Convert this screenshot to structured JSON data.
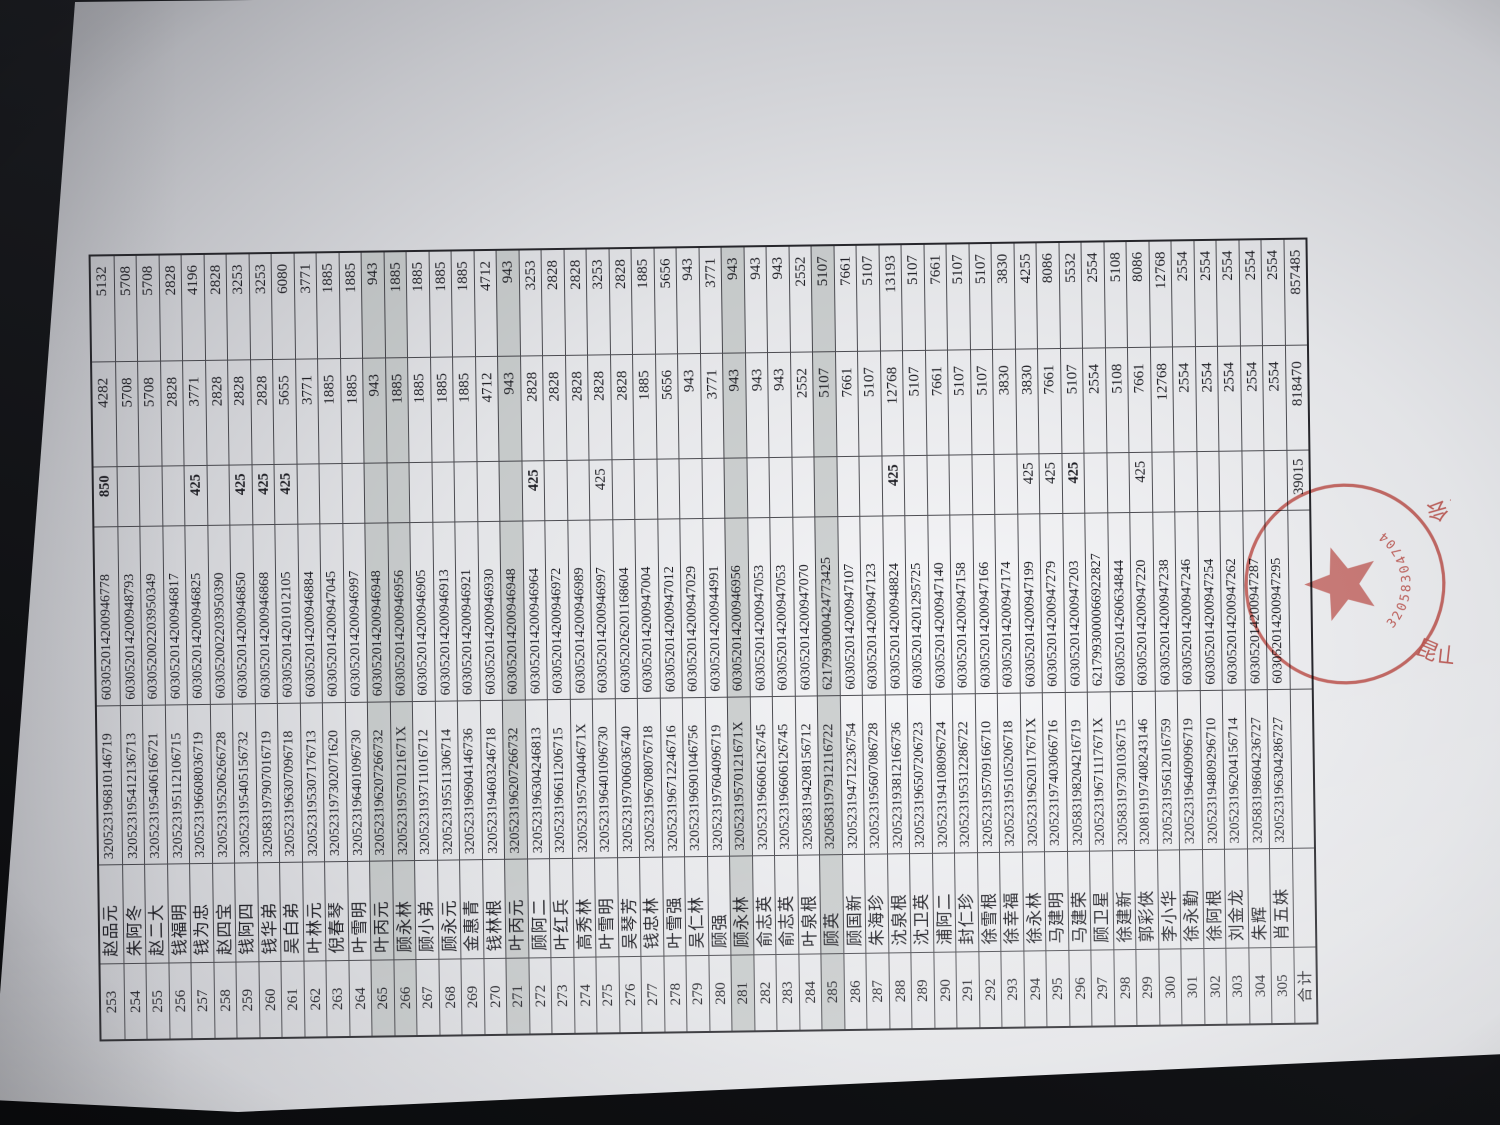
{
  "table": {
    "rows": [
      {
        "no": "253",
        "name": "赵品元",
        "id": "320523196810146719",
        "account": "603052014200946778",
        "adj": "850",
        "base": "4282",
        "total": "5132",
        "bold_adj": true
      },
      {
        "no": "254",
        "name": "朱阿冬",
        "id": "320523195412136713",
        "account": "603052014200948793",
        "adj": "",
        "base": "5708",
        "total": "5708"
      },
      {
        "no": "255",
        "name": "赵二大",
        "id": "320523195406166721",
        "account": "603052002203950349",
        "adj": "",
        "base": "5708",
        "total": "5708"
      },
      {
        "no": "256",
        "name": "钱福明",
        "id": "320523195112106715",
        "account": "603052014200946817",
        "adj": "",
        "base": "2828",
        "total": "2828"
      },
      {
        "no": "257",
        "name": "钱为忠",
        "id": "320523196608036719",
        "account": "603052014200946825",
        "adj": "425",
        "base": "3771",
        "total": "4196",
        "bold_adj": true
      },
      {
        "no": "258",
        "name": "赵四宝",
        "id": "320523195206266728",
        "account": "603052002203950390",
        "adj": "",
        "base": "2828",
        "total": "2828"
      },
      {
        "no": "259",
        "name": "钱阿四",
        "id": "320523195405156732",
        "account": "603052014200946850",
        "adj": "425",
        "base": "2828",
        "total": "3253",
        "bold_adj": true
      },
      {
        "no": "260",
        "name": "钱华弟",
        "id": "320583197907016719",
        "account": "603052014200946868",
        "adj": "425",
        "base": "2828",
        "total": "3253",
        "bold_adj": true
      },
      {
        "no": "261",
        "name": "吴白弟",
        "id": "320523196307096718",
        "account": "603052014201012105",
        "adj": "425",
        "base": "5655",
        "total": "6080",
        "bold_adj": true
      },
      {
        "no": "262",
        "name": "叶林元",
        "id": "320523195307176713",
        "account": "603052014200946884",
        "adj": "",
        "base": "3771",
        "total": "3771"
      },
      {
        "no": "263",
        "name": "倪春琴",
        "id": "320523197302071620",
        "account": "603052014200947045",
        "adj": "",
        "base": "1885",
        "total": "1885"
      },
      {
        "no": "264",
        "name": "叶雪明",
        "id": "320523196401096730",
        "account": "603052014200946997",
        "adj": "",
        "base": "1885",
        "total": "1885"
      },
      {
        "no": "265",
        "name": "叶丙元",
        "id": "320523196207266732",
        "account": "603052014200946948",
        "adj": "",
        "base": "943",
        "total": "943",
        "shaded": true
      },
      {
        "no": "266",
        "name": "顾永林",
        "id": "32052319570121671X",
        "account": "603052014200946956",
        "adj": "",
        "base": "1885",
        "total": "1885",
        "shaded": true
      },
      {
        "no": "267",
        "name": "顾小弟",
        "id": "320523193711016712",
        "account": "603052014200946905",
        "adj": "",
        "base": "1885",
        "total": "1885"
      },
      {
        "no": "268",
        "name": "顾永元",
        "id": "320523195511306714",
        "account": "603052014200946913",
        "adj": "",
        "base": "1885",
        "total": "1885"
      },
      {
        "no": "269",
        "name": "金惠青",
        "id": "320523196904146736",
        "account": "603052014200946921",
        "adj": "",
        "base": "1885",
        "total": "1885"
      },
      {
        "no": "270",
        "name": "钱林根",
        "id": "320523194603246718",
        "account": "603052014200946930",
        "adj": "",
        "base": "4712",
        "total": "4712"
      },
      {
        "no": "271",
        "name": "叶丙元",
        "id": "320523196207266732",
        "account": "603052014200946948",
        "adj": "",
        "base": "943",
        "total": "943",
        "shaded": true
      },
      {
        "no": "272",
        "name": "顾阿二",
        "id": "320523196304246813",
        "account": "603052014200946964",
        "adj": "425",
        "base": "2828",
        "total": "3253",
        "bold_adj": true
      },
      {
        "no": "273",
        "name": "叶红兵",
        "id": "320523196611206715",
        "account": "603052014200946972",
        "adj": "",
        "base": "2828",
        "total": "2828"
      },
      {
        "no": "274",
        "name": "高秀林",
        "id": "32052319570404671X",
        "account": "603052014200946989",
        "adj": "",
        "base": "2828",
        "total": "2828"
      },
      {
        "no": "275",
        "name": "叶雪明",
        "id": "320523196401096730",
        "account": "603052014200946997",
        "adj": "425",
        "base": "2828",
        "total": "3253"
      },
      {
        "no": "276",
        "name": "吴琴芳",
        "id": "320523197006036740",
        "account": "603052026201168604",
        "adj": "",
        "base": "2828",
        "total": "2828"
      },
      {
        "no": "277",
        "name": "钱忠林",
        "id": "320523196708076718",
        "account": "603052014200947004",
        "adj": "",
        "base": "1885",
        "total": "1885"
      },
      {
        "no": "278",
        "name": "叶雪强",
        "id": "320523196712246716",
        "account": "603052014200947012",
        "adj": "",
        "base": "5656",
        "total": "5656"
      },
      {
        "no": "279",
        "name": "吴仁林",
        "id": "320523196901046756",
        "account": "603052014200947029",
        "adj": "",
        "base": "943",
        "total": "943"
      },
      {
        "no": "280",
        "name": "顾强",
        "id": "320523197604096719",
        "account": "603052014200944991",
        "adj": "",
        "base": "3771",
        "total": "3771"
      },
      {
        "no": "281",
        "name": "顾永林",
        "id": "32052319570121671X",
        "account": "603052014200946956",
        "adj": "",
        "base": "943",
        "total": "943",
        "shaded": true
      },
      {
        "no": "282",
        "name": "俞志英",
        "id": "320523196606126745",
        "account": "603052014200947053",
        "adj": "",
        "base": "943",
        "total": "943"
      },
      {
        "no": "283",
        "name": "俞志英",
        "id": "320523196606126745",
        "account": "603052014200947053",
        "adj": "",
        "base": "943",
        "total": "943"
      },
      {
        "no": "284",
        "name": "叶泉根",
        "id": "320583194208156712",
        "account": "603052014200947070",
        "adj": "",
        "base": "2552",
        "total": "2552"
      },
      {
        "no": "285",
        "name": "顾英",
        "id": "320583197912116722",
        "account": "6217993000424773425",
        "adj": "",
        "base": "5107",
        "total": "5107",
        "shaded": true
      },
      {
        "no": "286",
        "name": "顾国新",
        "id": "320523194712236754",
        "account": "603052014200947107",
        "adj": "",
        "base": "7661",
        "total": "7661"
      },
      {
        "no": "287",
        "name": "朱海珍",
        "id": "320523195607086728",
        "account": "603052014200947123",
        "adj": "",
        "base": "5107",
        "total": "5107"
      },
      {
        "no": "288",
        "name": "沈泉根",
        "id": "320523193812166736",
        "account": "603052014200948824",
        "adj": "425",
        "base": "12768",
        "total": "13193",
        "bold_adj": true
      },
      {
        "no": "289",
        "name": "沈卫英",
        "id": "320523196507206723",
        "account": "603052014201295725",
        "adj": "",
        "base": "5107",
        "total": "5107"
      },
      {
        "no": "290",
        "name": "浦阿二",
        "id": "320523194108096724",
        "account": "603052014200947140",
        "adj": "",
        "base": "7661",
        "total": "7661"
      },
      {
        "no": "291",
        "name": "封仁珍",
        "id": "320523195312286722",
        "account": "603052014200947158",
        "adj": "",
        "base": "5107",
        "total": "5107"
      },
      {
        "no": "292",
        "name": "徐雪根",
        "id": "320523195709166710",
        "account": "603052014200947166",
        "adj": "",
        "base": "5107",
        "total": "5107"
      },
      {
        "no": "293",
        "name": "徐幸福",
        "id": "320523195105206718",
        "account": "603052014200947174",
        "adj": "",
        "base": "3830",
        "total": "3830"
      },
      {
        "no": "294",
        "name": "徐永林",
        "id": "32052319620117671X",
        "account": "603052014200947199",
        "adj": "425",
        "base": "3830",
        "total": "4255"
      },
      {
        "no": "295",
        "name": "马建明",
        "id": "320523197403066716",
        "account": "603052014200947279",
        "adj": "425",
        "base": "7661",
        "total": "8086"
      },
      {
        "no": "296",
        "name": "马建荣",
        "id": "320583198204216719",
        "account": "603052014200947203",
        "adj": "425",
        "base": "5107",
        "total": "5532",
        "bold_adj": true
      },
      {
        "no": "297",
        "name": "顾卫星",
        "id": "32052319671117671X",
        "account": "6217993000066922827",
        "adj": "",
        "base": "2554",
        "total": "2554"
      },
      {
        "no": "298",
        "name": "徐建新",
        "id": "320583197301036715",
        "account": "603052014260634844",
        "adj": "",
        "base": "5108",
        "total": "5108"
      },
      {
        "no": "299",
        "name": "郭彩俠",
        "id": "320819197408243146",
        "account": "603052014200947220",
        "adj": "425",
        "base": "7661",
        "total": "8086"
      },
      {
        "no": "300",
        "name": "李小华",
        "id": "320523195612016759",
        "account": "603052014200947238",
        "adj": "",
        "base": "12768",
        "total": "12768"
      },
      {
        "no": "301",
        "name": "徐永勤",
        "id": "320523196409096719",
        "account": "603052014200947246",
        "adj": "",
        "base": "2554",
        "total": "2554"
      },
      {
        "no": "302",
        "name": "徐阿根",
        "id": "320523194809296710",
        "account": "603052014200947254",
        "adj": "",
        "base": "2554",
        "total": "2554"
      },
      {
        "no": "303",
        "name": "刘金龙",
        "id": "320523196204156714",
        "account": "603052014200947262",
        "adj": "",
        "base": "2554",
        "total": "2554"
      },
      {
        "no": "304",
        "name": "朱辉",
        "id": "320583198604236727",
        "account": "603052014200947287",
        "adj": "",
        "base": "2554",
        "total": "2554"
      },
      {
        "no": "305",
        "name": "肖五妹",
        "id": "320523196304286727",
        "account": "603052014200947295",
        "adj": "",
        "base": "2554",
        "total": "2554"
      }
    ],
    "total_row": {
      "label": "合计",
      "adj": "39015",
      "base": "818470",
      "total": "857485"
    }
  },
  "stamp": {
    "ring_text": "昆山市千灯镇村村务监督委员会",
    "serial": "3205830470477",
    "ink_color": "#c4423a"
  }
}
